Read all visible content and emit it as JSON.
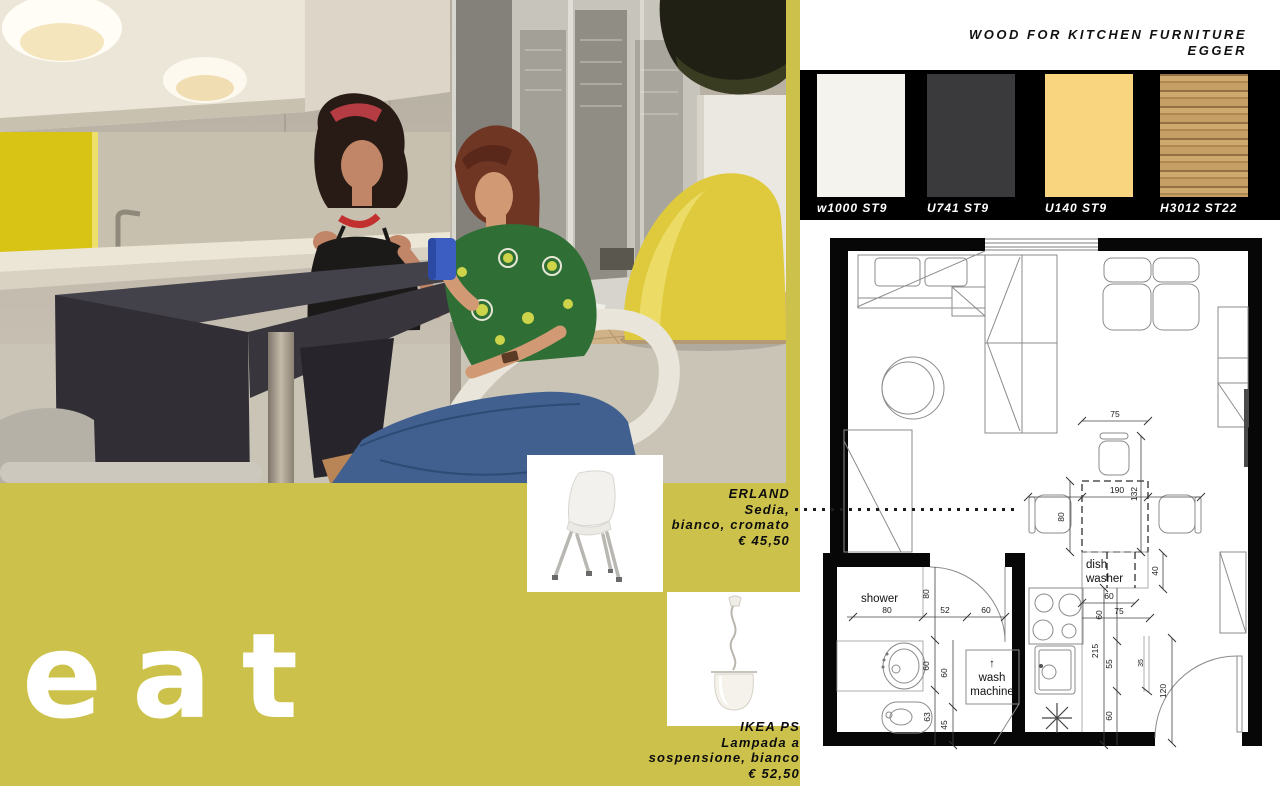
{
  "colors": {
    "olive": "#ccc24b",
    "band": "#000000",
    "accent_yellow": "#d8c414",
    "plan_wall": "#070707"
  },
  "hero_word": "eat",
  "materials": {
    "title_line1": "WOOD FOR KITCHEN FURNITURE",
    "title_line2": "EGGER",
    "swatches": [
      {
        "code": "w1000 ST9",
        "color": "#f4f3ee"
      },
      {
        "code": "U741 ST9",
        "color": "#3a3a3c"
      },
      {
        "code": "U140 ST9",
        "color": "#f8d57e"
      },
      {
        "code": "H3012 ST22",
        "color": "#bf9a62"
      }
    ]
  },
  "products": {
    "chair": {
      "name": "ERLAND",
      "line1": "Sedia,",
      "line2": "bianco, cromato",
      "price": "€ 45,50"
    },
    "lamp": {
      "name": "IKEA PS",
      "line1": "Lampada a",
      "line2": "sospensione, bianco",
      "price": "€ 52,50"
    }
  },
  "floor_plan": {
    "labels": {
      "shower": "shower",
      "wash_arrow": "↑",
      "wash1": "wash",
      "wash2": "machine",
      "dish1": "dish",
      "dish2": "washer"
    },
    "dims": {
      "chair_top": "75",
      "table_w": "190",
      "table_h": "132",
      "chair_left": "80",
      "gap_40": "40",
      "counter_60": "60",
      "counter_75": "75",
      "counter_60_rot": "60",
      "run_215": "215",
      "seg_55": "55",
      "seg_60": "60",
      "part_35": "35",
      "door_120": "120",
      "shower_w": "80",
      "shower_d": "80",
      "bath_52": "52",
      "bath_60": "60",
      "side_60": "60",
      "col_60": "60",
      "col_45": "45",
      "bidet_63": "63"
    }
  }
}
